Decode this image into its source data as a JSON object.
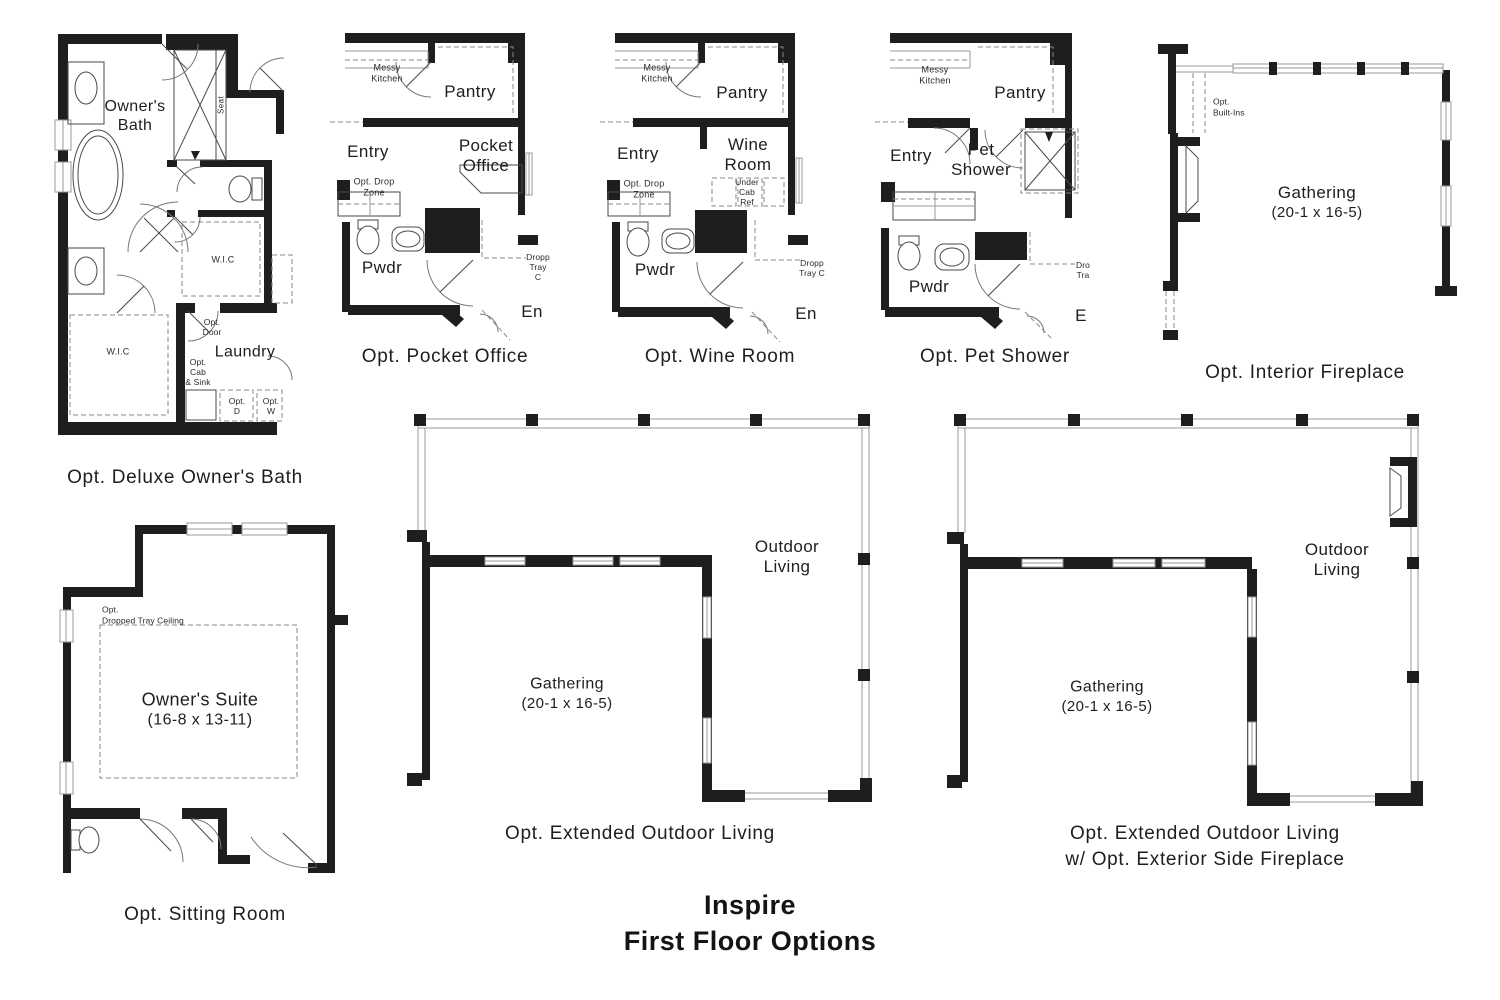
{
  "title": "Inspire\nFirst Floor Options",
  "colors": {
    "ink": "#1e1e1e",
    "background": "#ffffff"
  },
  "plans": {
    "deluxe_bath": {
      "caption": "Opt. Deluxe Owner's Bath",
      "labels": {
        "owners_bath": "Owner's\nBath",
        "seat": "Seat",
        "wic_upper": "W.I.C",
        "wic_lower": "W.I.C",
        "laundry": "Laundry",
        "opt_door": "Opt.\nDoor",
        "opt_cab_sink": "Opt.\nCab\n& Sink",
        "opt_d": "Opt.\nD",
        "opt_w": "Opt.\nW"
      }
    },
    "pocket_office": {
      "caption": "Opt. Pocket Office",
      "labels": {
        "messy_kitchen": "Messy\nKitchen",
        "pantry": "Pantry",
        "entry": "Entry",
        "opt_drop_zone": "Opt. Drop\nZone",
        "pocket_office": "Pocket\nOffice",
        "pwdr": "Pwdr",
        "dropped_tray": "Dropp\nTray C",
        "entry_clipped": "En"
      }
    },
    "wine_room": {
      "caption": "Opt. Wine Room",
      "labels": {
        "messy_kitchen": "Messy\nKitchen",
        "pantry": "Pantry",
        "entry": "Entry",
        "opt_drop_zone": "Opt. Drop\nZone",
        "wine_room": "Wine\nRoom",
        "under_cab_ref": "Under\nCab\nRef",
        "pwdr": "Pwdr",
        "dropped_tray": "Dropp\nTray C",
        "entry_clipped": "En"
      }
    },
    "pet_shower": {
      "caption": "Opt. Pet Shower",
      "labels": {
        "messy_kitchen": "Messy\nKitchen",
        "pantry": "Pantry",
        "entry": "Entry",
        "pet_shower": "Pet\nShower",
        "pwdr": "Pwdr",
        "dropped_tray": "Dro\nTra",
        "entry_clipped": "E"
      }
    },
    "interior_fireplace": {
      "caption": "Opt. Interior Fireplace",
      "labels": {
        "opt_built_ins": "Opt.\nBuilt-Ins",
        "gathering_name": "Gathering",
        "gathering_dims": "(20-1 x 16-5)"
      }
    },
    "sitting_room": {
      "caption": "Opt. Sitting Room",
      "labels": {
        "opt_tray": "Opt.\nDropped Tray Ceiling",
        "owners_suite_name": "Owner's Suite",
        "owners_suite_dims": "(16-8 x 13-11)"
      }
    },
    "extended_outdoor": {
      "caption": "Opt. Extended Outdoor Living",
      "labels": {
        "outdoor_living": "Outdoor\nLiving",
        "gathering_name": "Gathering",
        "gathering_dims": "(20-1 x 16-5)"
      }
    },
    "extended_outdoor_fireplace": {
      "caption": "Opt. Extended Outdoor Living\nw/ Opt. Exterior Side Fireplace",
      "labels": {
        "outdoor_living": "Outdoor\nLiving",
        "gathering_name": "Gathering",
        "gathering_dims": "(20-1 x 16-5)"
      }
    }
  }
}
